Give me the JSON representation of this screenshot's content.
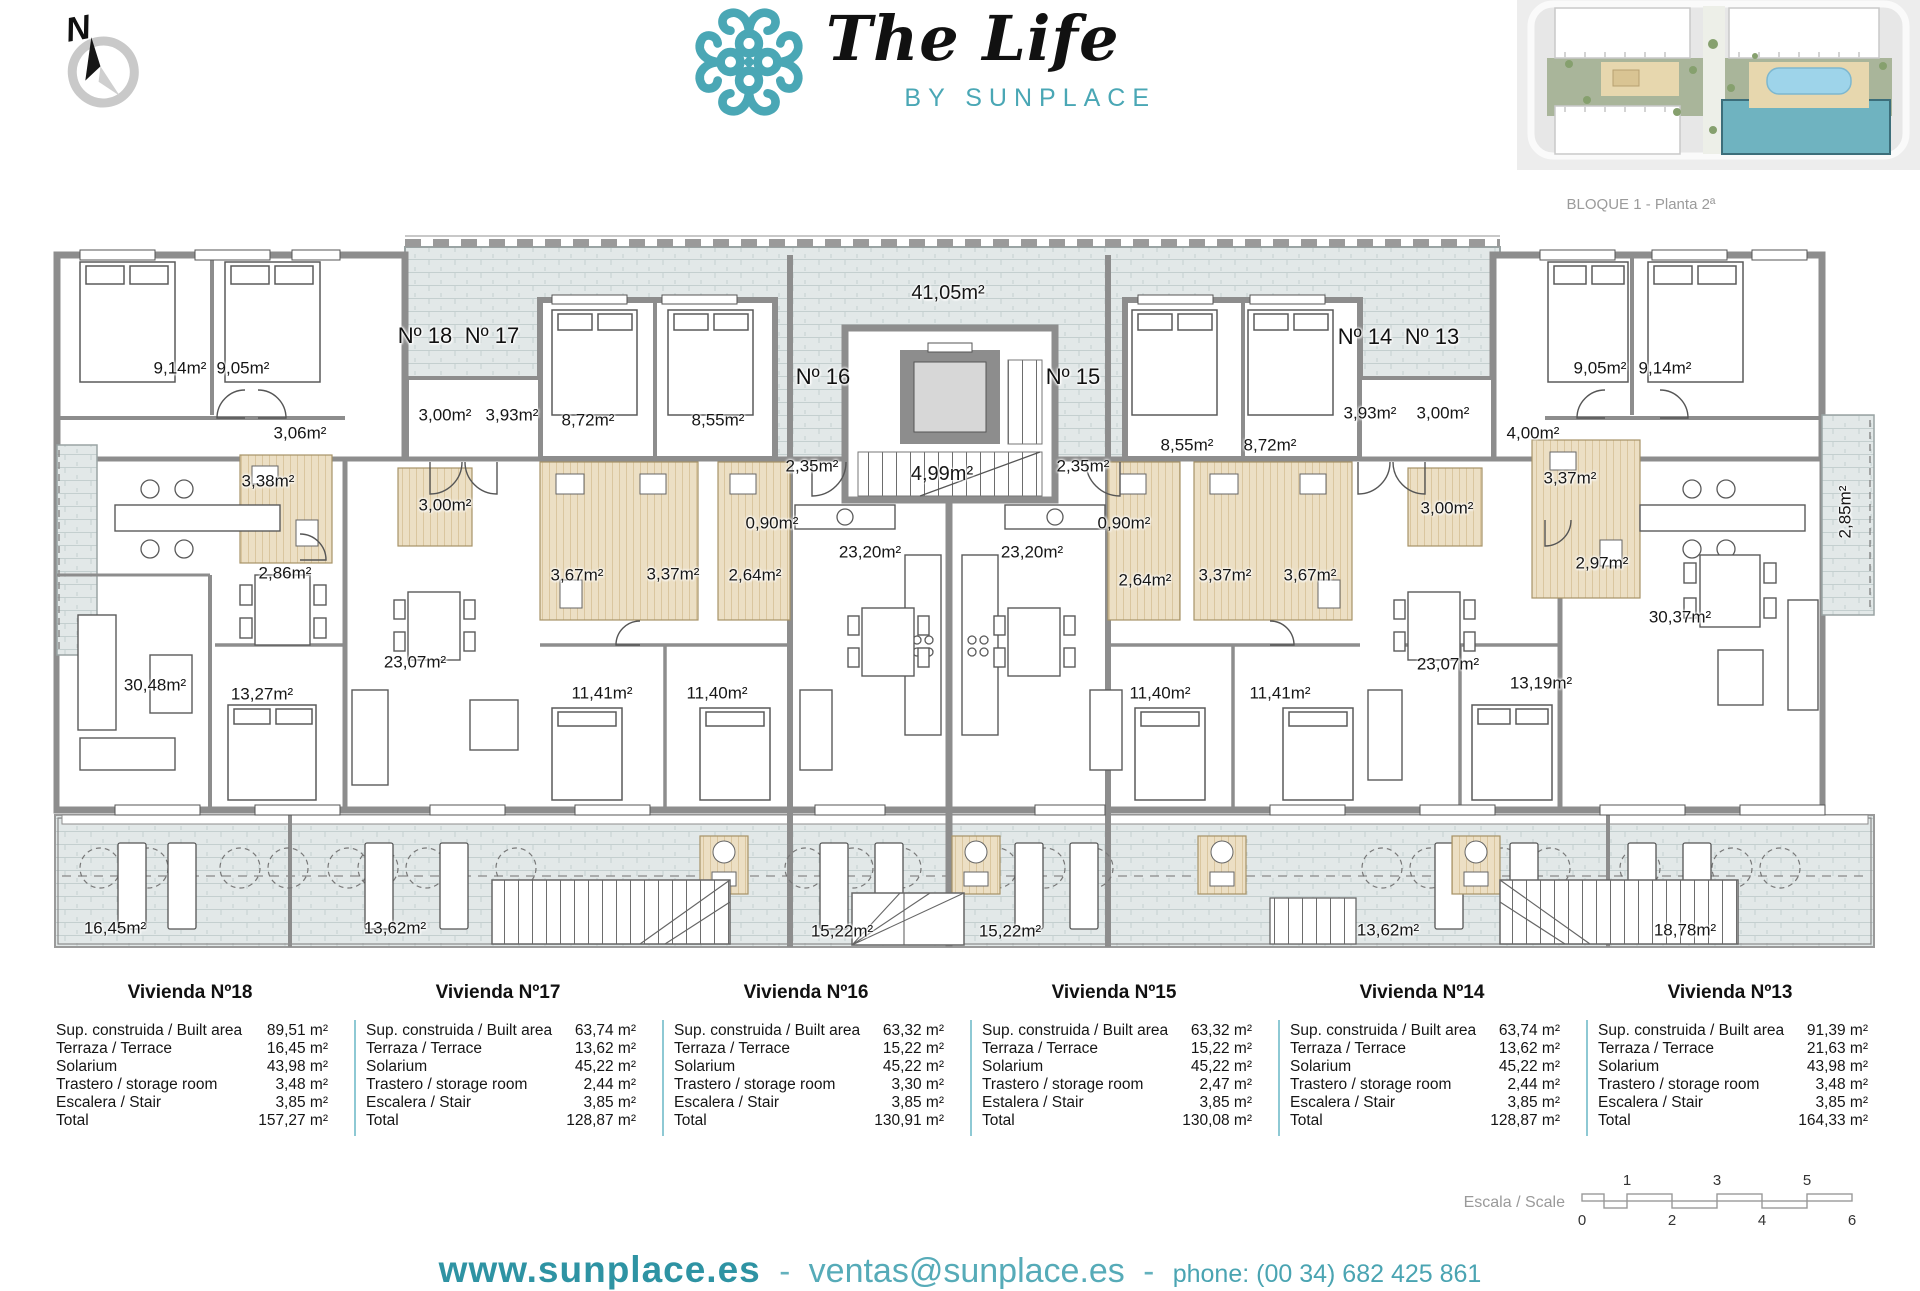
{
  "header": {
    "compass_n": "N",
    "logo_title": "The Life",
    "logo_subtitle": "BY SUNPLACE",
    "siteplan_caption": "BLOQUE 1 - Planta 2ª"
  },
  "plan": {
    "labels": [
      {
        "t": "9,14m²",
        "x": 180,
        "y": 368
      },
      {
        "t": "9,05m²",
        "x": 243,
        "y": 368
      },
      {
        "t": "Nº 18",
        "x": 425,
        "y": 336,
        "c": "n"
      },
      {
        "t": "Nº 17",
        "x": 492,
        "y": 336,
        "c": "n"
      },
      {
        "t": "3,06m²",
        "x": 300,
        "y": 433
      },
      {
        "t": "3,00m²",
        "x": 445,
        "y": 415
      },
      {
        "t": "3,93m²",
        "x": 512,
        "y": 415
      },
      {
        "t": "8,72m²",
        "x": 588,
        "y": 420
      },
      {
        "t": "8,55m²",
        "x": 718,
        "y": 420
      },
      {
        "t": "3,38m²",
        "x": 268,
        "y": 481
      },
      {
        "t": "3,00m²",
        "x": 445,
        "y": 505
      },
      {
        "t": "2,86m²",
        "x": 285,
        "y": 573
      },
      {
        "t": "3,67m²",
        "x": 577,
        "y": 575
      },
      {
        "t": "3,37m²",
        "x": 673,
        "y": 574
      },
      {
        "t": "2,64m²",
        "x": 755,
        "y": 575
      },
      {
        "t": "0,90m²",
        "x": 772,
        "y": 523
      },
      {
        "t": "2,35m²",
        "x": 812,
        "y": 466
      },
      {
        "t": "Nº 16",
        "x": 823,
        "y": 377,
        "c": "n"
      },
      {
        "t": "41,05m²",
        "x": 948,
        "y": 293,
        "c": "b"
      },
      {
        "t": "4,99m²",
        "x": 942,
        "y": 474,
        "c": "b"
      },
      {
        "t": "23,20m²",
        "x": 870,
        "y": 552
      },
      {
        "t": "23,20m²",
        "x": 1032,
        "y": 552
      },
      {
        "t": "30,48m²",
        "x": 155,
        "y": 685
      },
      {
        "t": "13,27m²",
        "x": 262,
        "y": 694
      },
      {
        "t": "23,07m²",
        "x": 415,
        "y": 662
      },
      {
        "t": "11,41m²",
        "x": 602,
        "y": 693
      },
      {
        "t": "11,40m²",
        "x": 717,
        "y": 693
      },
      {
        "t": "16,45m²",
        "x": 115,
        "y": 928
      },
      {
        "t": "13,62m²",
        "x": 395,
        "y": 928
      },
      {
        "t": "15,22m²",
        "x": 842,
        "y": 931
      },
      {
        "t": "Nº 15",
        "x": 1073,
        "y": 377,
        "c": "n"
      },
      {
        "t": "2,35m²",
        "x": 1083,
        "y": 466
      },
      {
        "t": "0,90m²",
        "x": 1124,
        "y": 523
      },
      {
        "t": "2,64m²",
        "x": 1145,
        "y": 580
      },
      {
        "t": "3,37m²",
        "x": 1225,
        "y": 575
      },
      {
        "t": "3,67m²",
        "x": 1310,
        "y": 575
      },
      {
        "t": "8,55m²",
        "x": 1187,
        "y": 445
      },
      {
        "t": "8,72m²",
        "x": 1270,
        "y": 445
      },
      {
        "t": "Nº 14",
        "x": 1365,
        "y": 337,
        "c": "n"
      },
      {
        "t": "Nº 13",
        "x": 1432,
        "y": 337,
        "c": "n"
      },
      {
        "t": "3,93m²",
        "x": 1370,
        "y": 413
      },
      {
        "t": "3,00m²",
        "x": 1443,
        "y": 413
      },
      {
        "t": "9,05m²",
        "x": 1600,
        "y": 368
      },
      {
        "t": "9,14m²",
        "x": 1665,
        "y": 368
      },
      {
        "t": "4,00m²",
        "x": 1533,
        "y": 433
      },
      {
        "t": "3,00m²",
        "x": 1447,
        "y": 508
      },
      {
        "t": "3,37m²",
        "x": 1570,
        "y": 478
      },
      {
        "t": "2,97m²",
        "x": 1602,
        "y": 563
      },
      {
        "t": "2,85m²",
        "x": 1845,
        "y": 512,
        "c": "v"
      },
      {
        "t": "11,40m²",
        "x": 1160,
        "y": 693
      },
      {
        "t": "11,41m²",
        "x": 1280,
        "y": 693
      },
      {
        "t": "23,07m²",
        "x": 1448,
        "y": 664
      },
      {
        "t": "13,19m²",
        "x": 1541,
        "y": 683
      },
      {
        "t": "30,37m²",
        "x": 1680,
        "y": 617
      },
      {
        "t": "15,22m²",
        "x": 1010,
        "y": 931
      },
      {
        "t": "13,62m²",
        "x": 1388,
        "y": 930
      },
      {
        "t": "18,78m²",
        "x": 1685,
        "y": 930
      }
    ]
  },
  "tables": {
    "viviendas": [
      {
        "title": "Vivienda Nº18",
        "rows": [
          [
            "Sup. construida / Built area",
            "89,51 m²"
          ],
          [
            "Terraza / Terrace",
            "16,45 m²"
          ],
          [
            "Solarium",
            "43,98 m²"
          ],
          [
            "Trastero / storage room",
            "3,48 m²"
          ],
          [
            "Escalera / Stair",
            "3,85 m²"
          ],
          [
            "Total",
            "157,27 m²"
          ]
        ]
      },
      {
        "title": "Vivienda Nº17",
        "rows": [
          [
            "Sup. construida / Built area",
            "63,74 m²"
          ],
          [
            "Terraza / Terrace",
            "13,62 m²"
          ],
          [
            "Solarium",
            "45,22 m²"
          ],
          [
            "Trastero / storage room",
            "2,44 m²"
          ],
          [
            "Escalera / Stair",
            "3,85 m²"
          ],
          [
            "Total",
            "128,87 m²"
          ]
        ]
      },
      {
        "title": "Vivienda Nº16",
        "rows": [
          [
            "Sup. construida / Built area",
            "63,32 m²"
          ],
          [
            "Terraza / Terrace",
            "15,22 m²"
          ],
          [
            "Solarium",
            "45,22 m²"
          ],
          [
            "Trastero / storage room",
            "3,30 m²"
          ],
          [
            "Escalera / Stair",
            "3,85 m²"
          ],
          [
            "Total",
            "130,91 m²"
          ]
        ]
      },
      {
        "title": "Vivienda Nº15",
        "rows": [
          [
            "Sup. construida / Built area",
            "63,32 m²"
          ],
          [
            "Terraza / Terrace",
            "15,22 m²"
          ],
          [
            "Solarium",
            "45,22 m²"
          ],
          [
            "Trastero / storage room",
            "2,47 m²"
          ],
          [
            "Estalera / Stair",
            "3,85 m²"
          ],
          [
            "Total",
            "130,08 m²"
          ]
        ]
      },
      {
        "title": "Vivienda Nº14",
        "rows": [
          [
            "Sup. construida / Built area",
            "63,74 m²"
          ],
          [
            "Terraza / Terrace",
            "13,62 m²"
          ],
          [
            "Solarium",
            "45,22 m²"
          ],
          [
            "Trastero / storage room",
            "2,44 m²"
          ],
          [
            "Escalera / Stair",
            "3,85 m²"
          ],
          [
            "Total",
            "128,87 m²"
          ]
        ]
      },
      {
        "title": "Vivienda Nº13",
        "rows": [
          [
            "Sup. construida / Built area",
            "91,39 m²"
          ],
          [
            "Terraza / Terrace",
            "21,63 m²"
          ],
          [
            "Solarium",
            "43,98 m²"
          ],
          [
            "Trastero / storage room",
            "3,48 m²"
          ],
          [
            "Escalera / Stair",
            "3,85 m²"
          ],
          [
            "Total",
            "164,33 m²"
          ]
        ]
      }
    ]
  },
  "scale": {
    "label": "Escala / Scale",
    "top_numbers": [
      "1",
      "3",
      "5"
    ],
    "bottom_numbers": [
      "0",
      "2",
      "4",
      "6"
    ]
  },
  "footer": {
    "web": "www.sunplace.es",
    "sep1": "-",
    "email": "ventas@sunplace.es",
    "sep2": "-",
    "phone": "phone: (00 34) 682 425 861"
  },
  "colors": {
    "accent_teal": "#4aa7b5",
    "wall_gray": "#8d8d8d",
    "tile": "#e2e8e8",
    "bath": "#ecdfc4"
  }
}
